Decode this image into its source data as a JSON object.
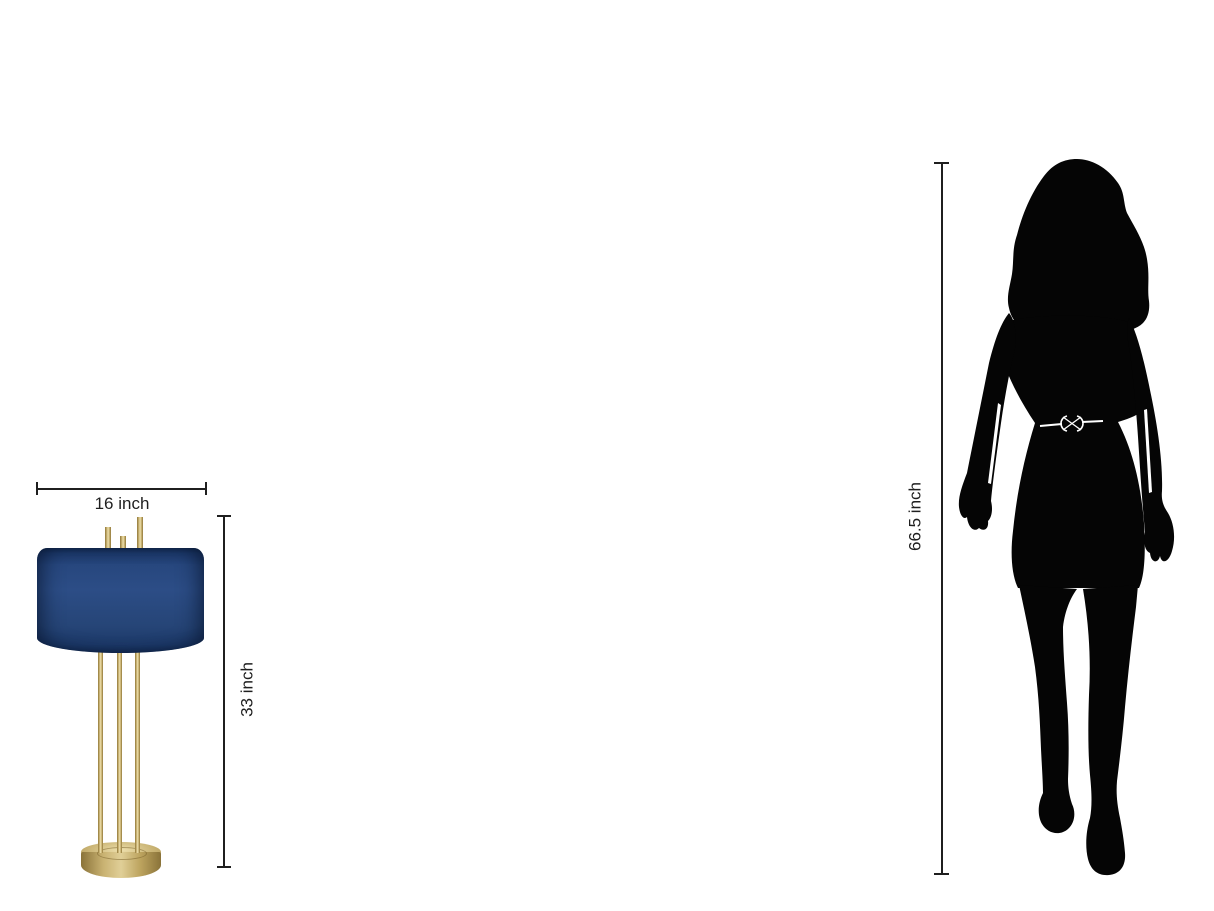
{
  "image": {
    "description": "Product size comparison diagram: blue drum-shade table lamp shown to scale beside a woman silhouette",
    "background_color": "#ffffff",
    "annotation_color": "#1f1f1f"
  },
  "lamp": {
    "name": "table lamp with navy drum shade and three brass rods on round brass base",
    "width_label": "16 inch",
    "width_value": 16,
    "height_label": "33 inch",
    "height_value": 33,
    "unit": "inch",
    "shade_color": "#27477e",
    "shade_rim_color": "#152c55",
    "brass_color": "#c8b272",
    "brass_highlight": "#eee0ad",
    "brass_shadow": "#8f7638"
  },
  "person": {
    "name": "woman silhouette (walking, short belted dress, long hair)",
    "height_label": "66.5 inch",
    "height_value": 66.5,
    "unit": "inch",
    "silhouette_color": "#050505",
    "belt_color": "#ffffff"
  }
}
